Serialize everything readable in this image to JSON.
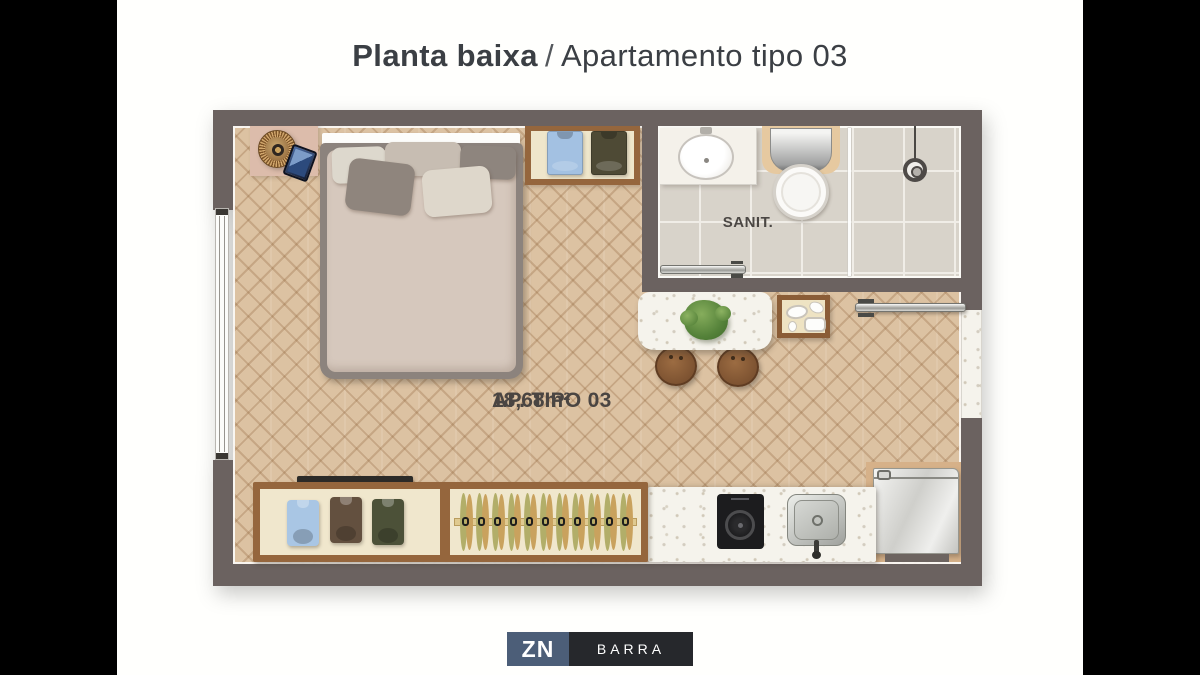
{
  "title": {
    "primary": "Planta baixa",
    "separator": "/",
    "secondary": "Apartamento tipo 03"
  },
  "plan": {
    "unit_label": "AP. TIPO 03",
    "unit_area": "18,68m²",
    "bathroom_label": "SANIT.",
    "closet_hanger_count": 11,
    "wardrobe_shirt_colors": [
      "#a9c6e4",
      "#63503f",
      "#4c5138"
    ],
    "top_closet_shirt_colors": [
      "#a3c1e2",
      "#4e4a35"
    ]
  },
  "colors": {
    "wall": "#6b6260",
    "floor": "#dcc2a2",
    "tile": "#d8d3ca",
    "marble": "#f5f3ec",
    "wood": "#95663d",
    "closet": "#f0e7cd",
    "rail": "#e0ca90",
    "leaf_olive": "#b2ae69",
    "leaf_tan": "#c9a25e",
    "bed_frame": "#8c837d",
    "mattress": "#d6c8bd",
    "text": "#4a4542",
    "logo_blue": "#4c5e78",
    "logo_dark": "#26282c"
  },
  "logo": {
    "zn": "ZN",
    "barra": "BARRA"
  }
}
